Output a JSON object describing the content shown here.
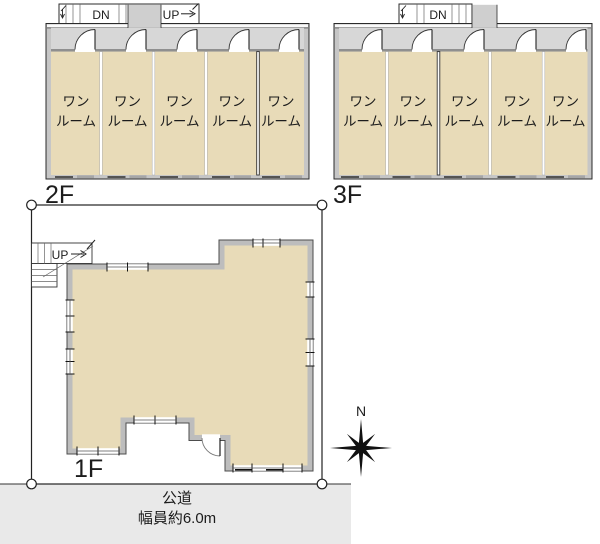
{
  "floor2": {
    "label": "2F",
    "stair": {
      "down": "DN",
      "up": "UP"
    },
    "rooms": [
      {
        "line1": "ワン",
        "line2": "ルーム"
      },
      {
        "line1": "ワン",
        "line2": "ルーム"
      },
      {
        "line1": "ワン",
        "line2": "ルーム"
      },
      {
        "line1": "ワン",
        "line2": "ルーム"
      },
      {
        "line1": "ワン",
        "line2": "ルーム"
      }
    ]
  },
  "floor3": {
    "label": "3F",
    "stair": {
      "down": "DN"
    },
    "rooms": [
      {
        "line1": "ワン",
        "line2": "ルーム"
      },
      {
        "line1": "ワン",
        "line2": "ルーム"
      },
      {
        "line1": "ワン",
        "line2": "ルーム"
      },
      {
        "line1": "ワン",
        "line2": "ルーム"
      },
      {
        "line1": "ワン",
        "line2": "ルーム"
      }
    ]
  },
  "floor1": {
    "label": "1F",
    "stair": {
      "up": "UP"
    }
  },
  "road": {
    "label": "公道",
    "width_label": "幅員約6.0m"
  },
  "compass": {
    "label": "N"
  },
  "colors": {
    "room_fill": "#e8dbb8",
    "wall_gray": "#c6c6c6",
    "corridor_gray": "#d7d7d7",
    "road_gray": "#e9e9e9",
    "line": "#222222"
  }
}
